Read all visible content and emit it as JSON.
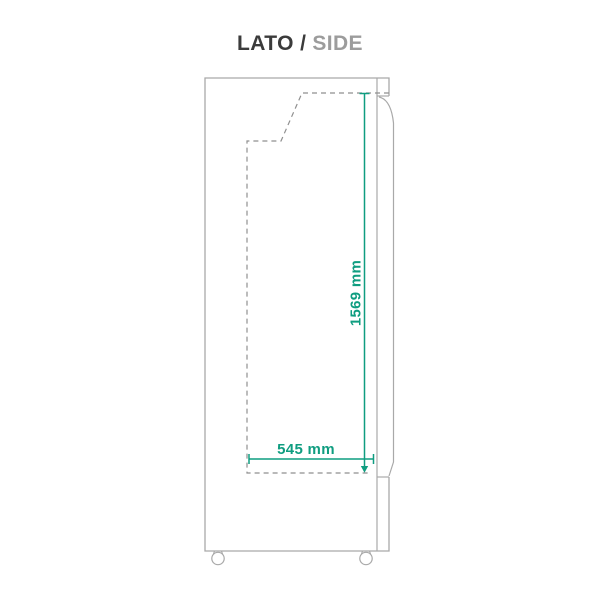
{
  "header": {
    "title_primary": "LATO /",
    "title_secondary": "SIDE"
  },
  "diagram": {
    "name": "cabinet-side-view-technical-drawing",
    "colors": {
      "accent_green": "#0f9d80",
      "outline_gray": "#a9a9a9",
      "dash_gray": "#8f8f8f",
      "title_dark": "#3b3b3b",
      "title_muted": "#9c9c9c"
    },
    "dimensions": {
      "height": {
        "label": "1569 mm",
        "value": 1569,
        "unit": "mm",
        "orientation": "vertical"
      },
      "depth": {
        "label": "545 mm",
        "value": 545,
        "unit": "mm",
        "orientation": "horizontal"
      }
    }
  }
}
